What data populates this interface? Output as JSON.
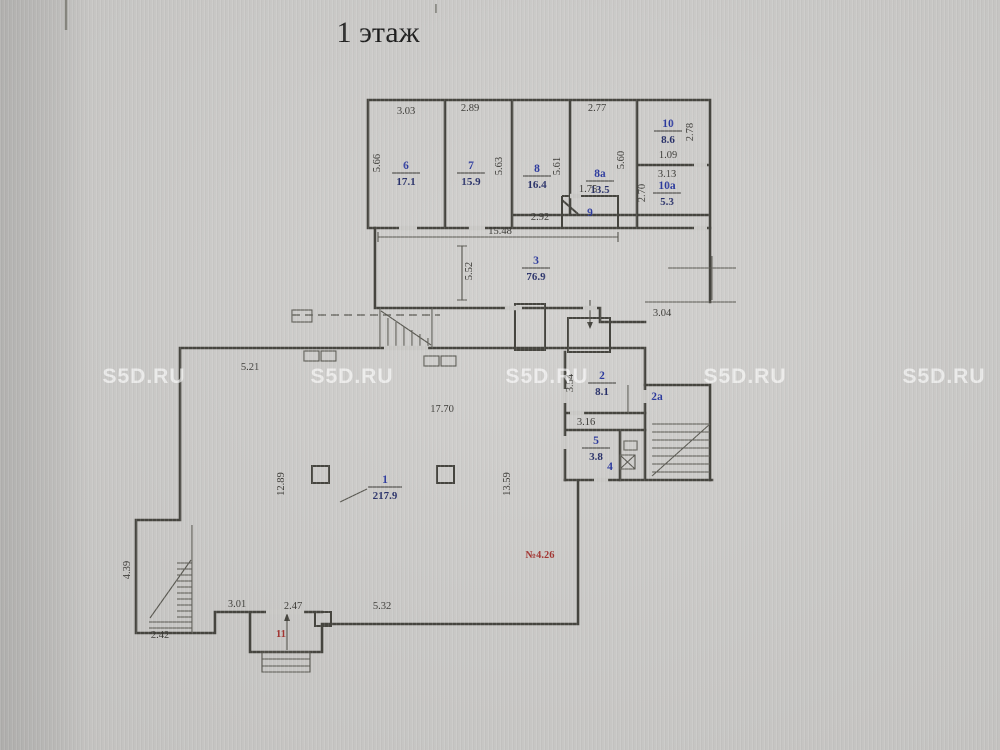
{
  "title": "1 этаж",
  "watermark": {
    "text": "S5D.RU"
  },
  "annotations": {
    "red_note": "№4.26"
  },
  "colors": {
    "paper": "#c9c8c6",
    "line": "#46453f",
    "room_number_blue": "#2c3a9e",
    "room_area_navy": "#293169",
    "red": "#a23532",
    "watermark_white": "#ffffff"
  },
  "rooms": {
    "r1": {
      "num": "1",
      "area": "217.9"
    },
    "r2": {
      "num": "2",
      "area": "8.1"
    },
    "r2a": {
      "num": "2а"
    },
    "r3": {
      "num": "3",
      "area": "76.9"
    },
    "r4": {
      "num": "4"
    },
    "r5": {
      "num": "5",
      "area": "3.8"
    },
    "r6": {
      "num": "6",
      "area": "17.1"
    },
    "r7": {
      "num": "7",
      "area": "15.9"
    },
    "r8": {
      "num": "8",
      "area": "16.4"
    },
    "r8a": {
      "num": "8а",
      "area": "13.5"
    },
    "r9": {
      "num": "9"
    },
    "r10": {
      "num": "10",
      "area": "8.6"
    },
    "r10a": {
      "num": "10а",
      "area": "5.3"
    },
    "r11": {
      "num": "11"
    }
  },
  "dims": {
    "top": {
      "w6": "3.03",
      "w7": "2.89",
      "w8a": "2.77",
      "h6": "5.66",
      "h7": "5.63",
      "h8": "5.61",
      "h8a": "5.60",
      "w9": "1.75",
      "w10b": "1.09",
      "h10": "2.78",
      "w10a": "3.13",
      "h10a": "2.70",
      "corr": "2.92",
      "total": "15.48"
    },
    "mid": {
      "h3": "5.52",
      "r3": "3.04"
    },
    "main": {
      "top": "5.21",
      "w1": "17.70",
      "left": "12.89",
      "right": "13.59",
      "h2": "3.54",
      "c316": "3.16",
      "b301": "3.01",
      "b247": "2.47",
      "b532": "5.32",
      "b242": "2.42",
      "left2": "4.39"
    }
  }
}
